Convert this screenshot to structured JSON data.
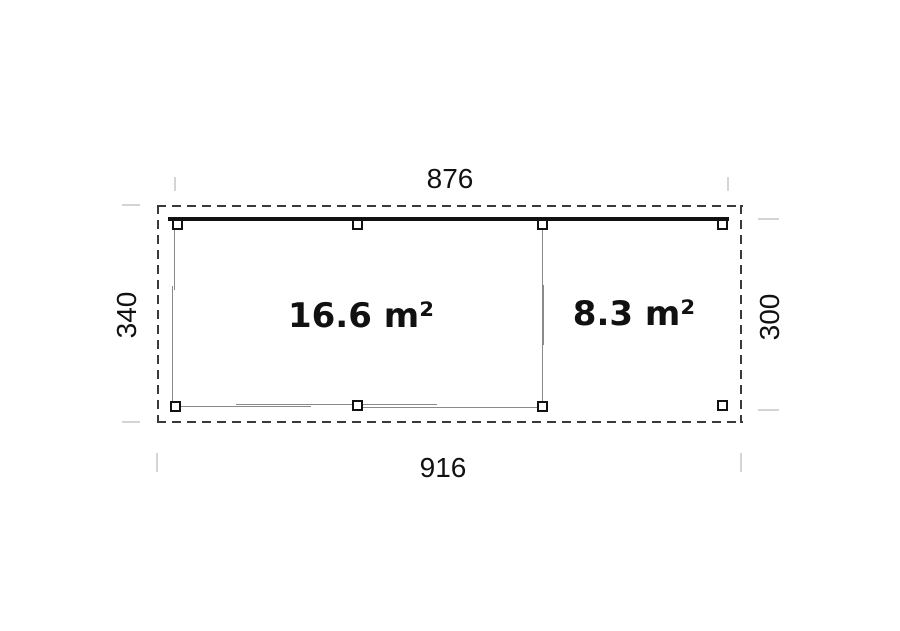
{
  "plan": {
    "type": "floor-plan",
    "dimensions": {
      "width_top": "876",
      "width_bottom": "916",
      "depth_left": "340",
      "depth_right": "300"
    },
    "rooms": [
      {
        "name": "enclosed-room",
        "area_label": "16.6 m²"
      },
      {
        "name": "open-canopy",
        "area_label": "8.3 m²"
      }
    ],
    "colors": {
      "outline_dash": "#3a3a3a",
      "beam": "#111111",
      "wall_line": "#8a8a8a",
      "extension_tick": "#d4d4d4",
      "text": "#111111",
      "background": "#ffffff"
    }
  }
}
